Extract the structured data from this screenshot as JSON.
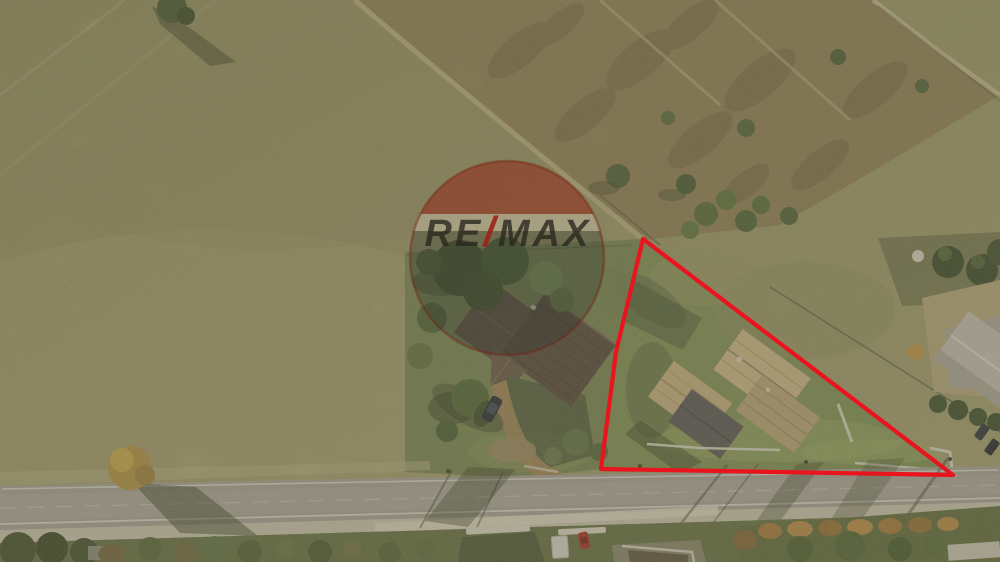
{
  "watermark": {
    "brand_left": "RE",
    "slash": "/",
    "brand_right": "MAX",
    "slash_color": "rgba(158,32,18,0.88)",
    "text_color": "rgba(42,39,31,0.80)",
    "balloon_top_color": "rgba(146,36,22,0.52)",
    "balloon_band_color": "rgba(212,203,182,0.40)",
    "balloon_bottom_color": "rgba(38,46,40,0.28)"
  },
  "boundary": {
    "color": "#ea141f"
  }
}
